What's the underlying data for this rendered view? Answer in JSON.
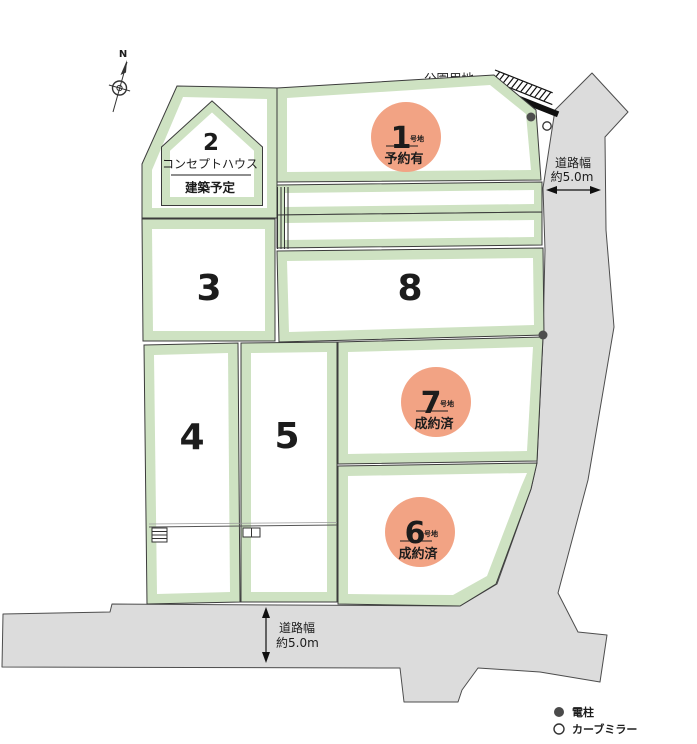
{
  "plan": {
    "compass": {
      "north": "N"
    },
    "park": {
      "label": "公園用地"
    },
    "road_width": {
      "label": "道路幅",
      "value": "約5.0m"
    },
    "lots": {
      "lot1": {
        "number": "1",
        "unit": "号地",
        "status": "予約有"
      },
      "lot2": {
        "number": "2",
        "title": "コンセプトハウス",
        "subtitle": "建築予定"
      },
      "lot3": {
        "number": "3"
      },
      "lot4": {
        "number": "4"
      },
      "lot5": {
        "number": "5"
      },
      "lot6": {
        "number": "6",
        "unit": "号地",
        "status": "成約済"
      },
      "lot7": {
        "number": "7",
        "unit": "号地",
        "status": "成約済"
      },
      "lot8": {
        "number": "8"
      }
    },
    "legend": {
      "pole": "電柱",
      "mirror": "カーブミラー"
    },
    "colors": {
      "badge": "#F2A384",
      "lot_border": "#CEE2C2",
      "road": "#DCDCDC"
    }
  }
}
